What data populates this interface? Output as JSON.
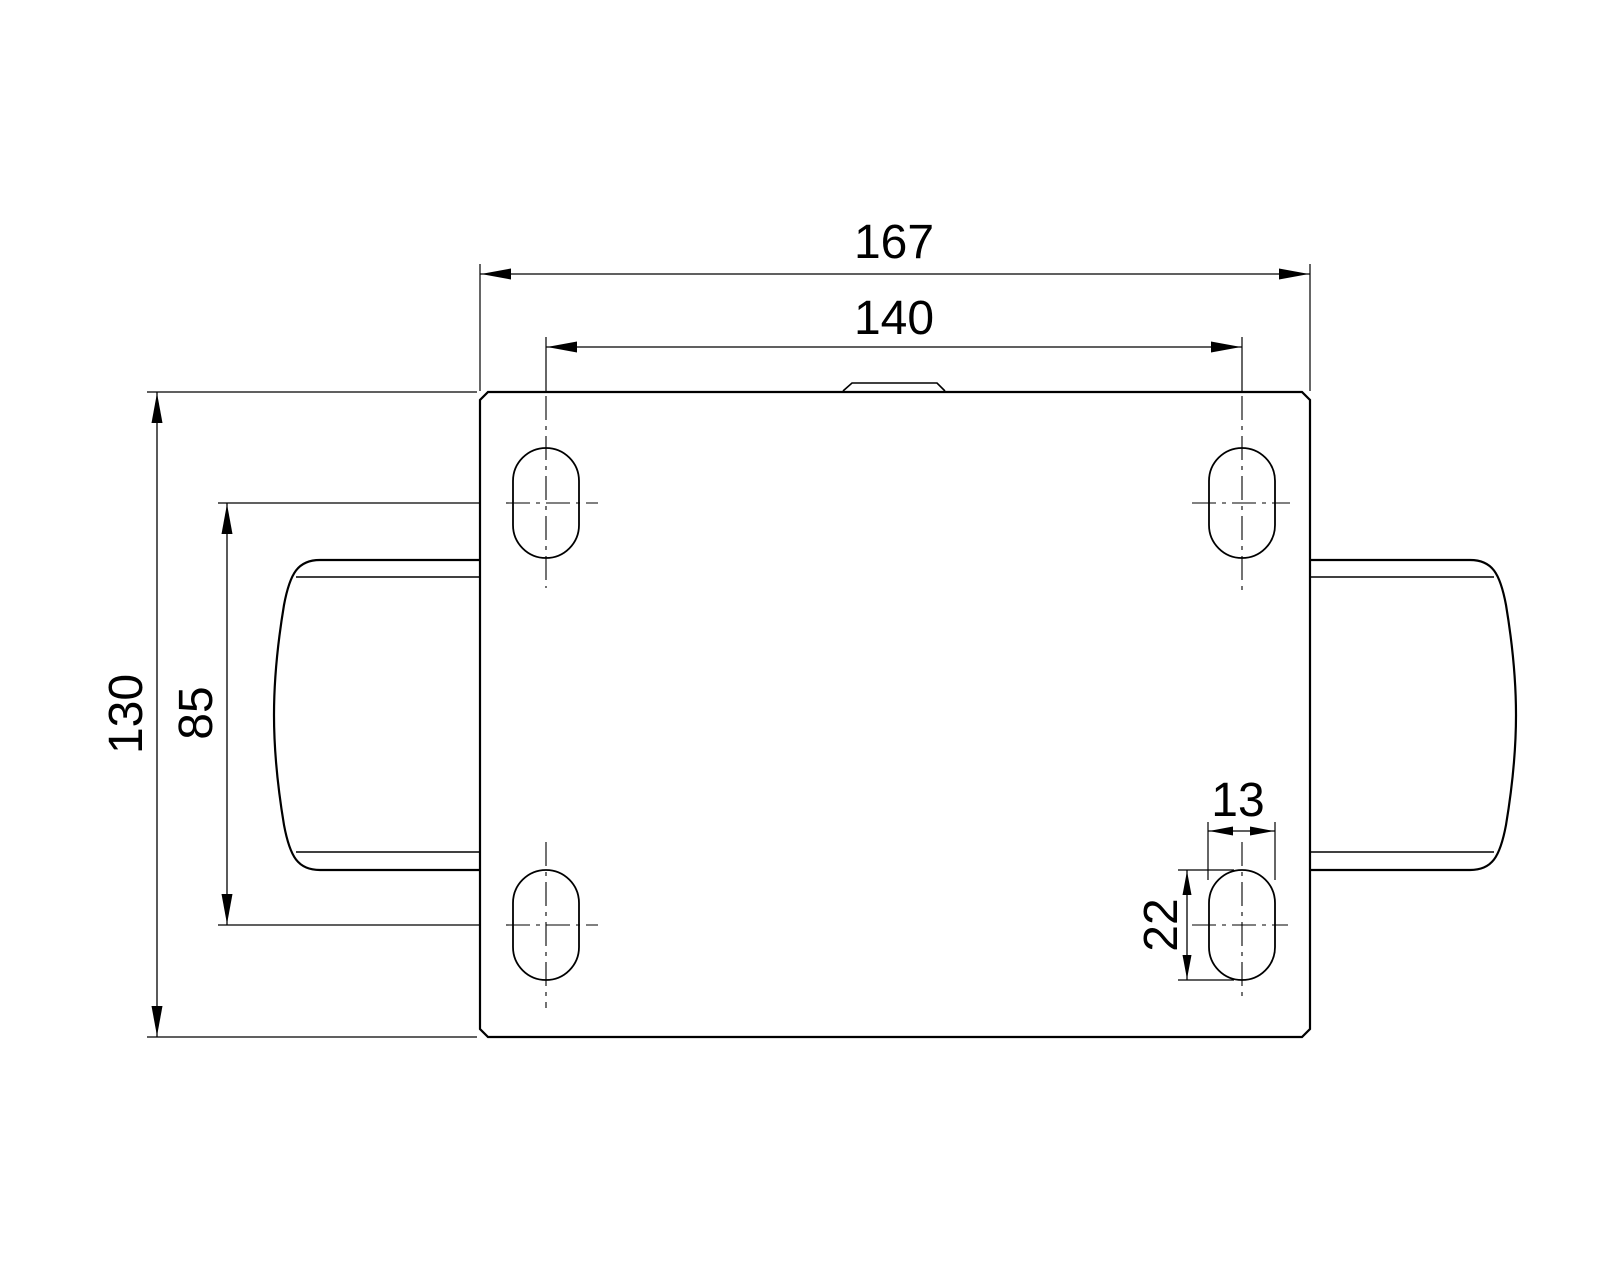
{
  "page": {
    "background_color": "#ffffff",
    "line_color": "#000000"
  },
  "drawing": {
    "kind": "engineering-dimension-drawing",
    "dimensions": {
      "plate_width": "167",
      "hole_spacing_width": "140",
      "plate_depth": "130",
      "hole_spacing_depth": "85",
      "slot_width": "13",
      "slot_length": "22"
    }
  }
}
